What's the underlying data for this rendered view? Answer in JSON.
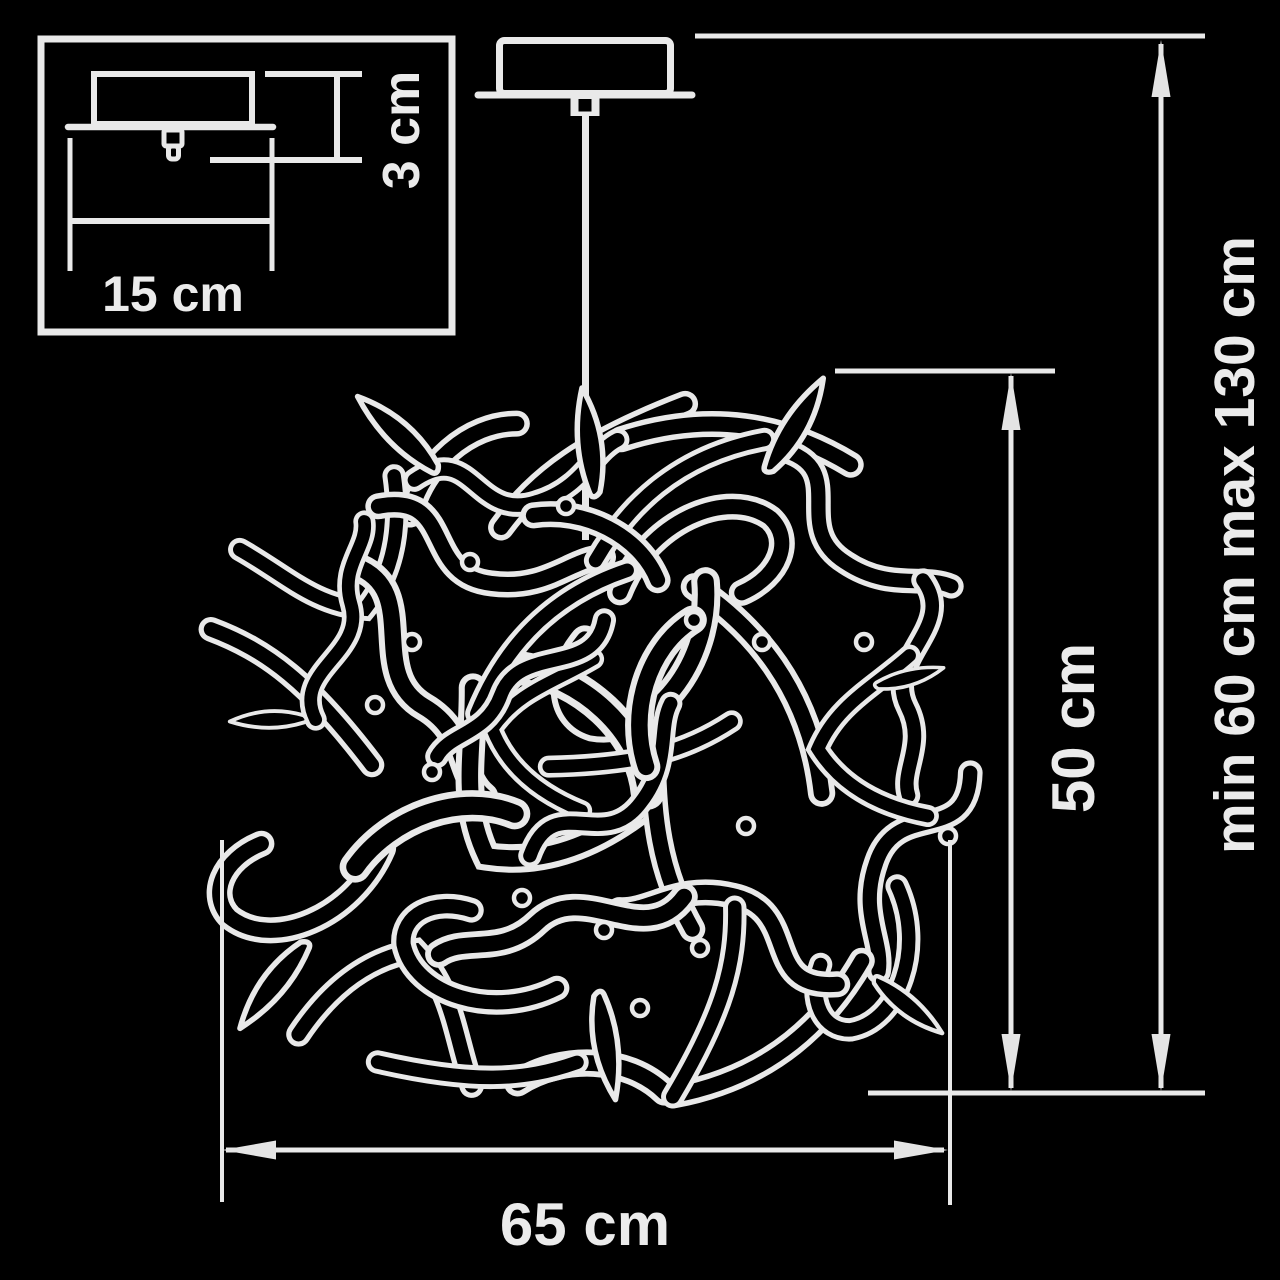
{
  "inset": {
    "width_label": "15 cm",
    "height_label": "3 cm"
  },
  "main": {
    "shade_width_label": "65 cm",
    "shade_height_label": "50 cm",
    "overall_height_label": "min 60 cm max 130 cm"
  },
  "colors": {
    "background": "#000000",
    "line": "#e9e9e9",
    "text": "#ebebeb"
  }
}
